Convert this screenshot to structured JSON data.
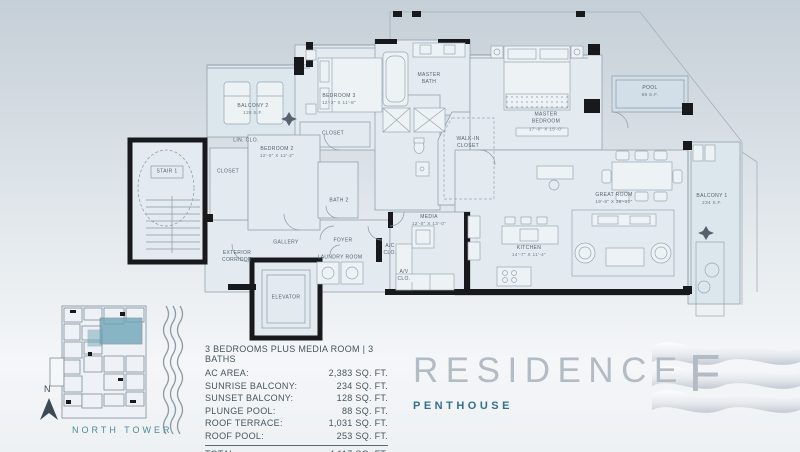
{
  "title": {
    "residence": "RESIDENCE",
    "letter": "F",
    "subtitle": "PENTHOUSE"
  },
  "key_plan": {
    "north": "N",
    "tower": "NORTH TOWER"
  },
  "legend": {
    "header": "3 BEDROOMS PLUS MEDIA ROOM | 3 BATHS",
    "rows": [
      {
        "label": "AC AREA:",
        "value": "2,383 SQ. FT."
      },
      {
        "label": "SUNRISE BALCONY:",
        "value": "234 SQ. FT."
      },
      {
        "label": "SUNSET BALCONY:",
        "value": "128 SQ. FT."
      },
      {
        "label": "PLUNGE POOL:",
        "value": "88 SQ. FT."
      },
      {
        "label": "ROOF TERRACE:",
        "value": "1,031 SQ. FT."
      },
      {
        "label": "ROOF POOL:",
        "value": "253 SQ. FT."
      }
    ],
    "total": {
      "label": "TOTAL:",
      "value": "4,117 SQ. FT."
    }
  },
  "rooms": {
    "balcony2": {
      "line1": "BALCONY 2",
      "line2": "128 S.F."
    },
    "bedroom3": {
      "line1": "BEDROOM 3",
      "line2": "12'-2\" X 11'-8\""
    },
    "closet_b3": {
      "line1": "CLOSET"
    },
    "lin_clo": {
      "line1": "LIN. CLO."
    },
    "closet_b2": {
      "line1": "CLOSET"
    },
    "stair1": {
      "line1": "STAIR 1"
    },
    "bedroom2": {
      "line1": "BEDROOM 2",
      "line2": "12'-0\" X 12'-2\""
    },
    "bath2": {
      "line1": "BATH 2"
    },
    "master_bath": {
      "line1": "MASTER",
      "line2": "BATH"
    },
    "master_bedroom": {
      "line1": "MASTER",
      "line2": "BEDROOM",
      "line3": "17'-0\" X 15'-0\""
    },
    "pool": {
      "line1": "POOL",
      "line2": "88 S.F."
    },
    "walk_in": {
      "line1": "WALK-IN",
      "line2": "CLOSET"
    },
    "ext_corridor": {
      "line1": "EXTERIOR",
      "line2": "CORRIDOR"
    },
    "gallery": {
      "line1": "GALLERY"
    },
    "foyer": {
      "line1": "FOYER"
    },
    "laundry": {
      "line1": "LAUNDRY ROOM"
    },
    "ac_clo": {
      "line1": "A/C",
      "line2": "CLO."
    },
    "av_clo": {
      "line1": "A/V",
      "line2": "CLO."
    },
    "elevator": {
      "line1": "ELEVATOR"
    },
    "media": {
      "line1": "MEDIA",
      "line2": "12'-0\" X 13'-0\""
    },
    "kitchen": {
      "line1": "KITCHEN",
      "line2": "14'-7\" X 11'-4\""
    },
    "great_room": {
      "line1": "GREAT ROOM",
      "line2": "19'-8\" X 36'-10\""
    },
    "balcony1": {
      "line1": "BALCONY 1",
      "line2": "234 S.F."
    }
  },
  "colors": {
    "accent_teal": "#34718a",
    "tower_teal": "#4b8b9b",
    "wall_black": "#17191c",
    "line_gray": "#8a99a5"
  }
}
